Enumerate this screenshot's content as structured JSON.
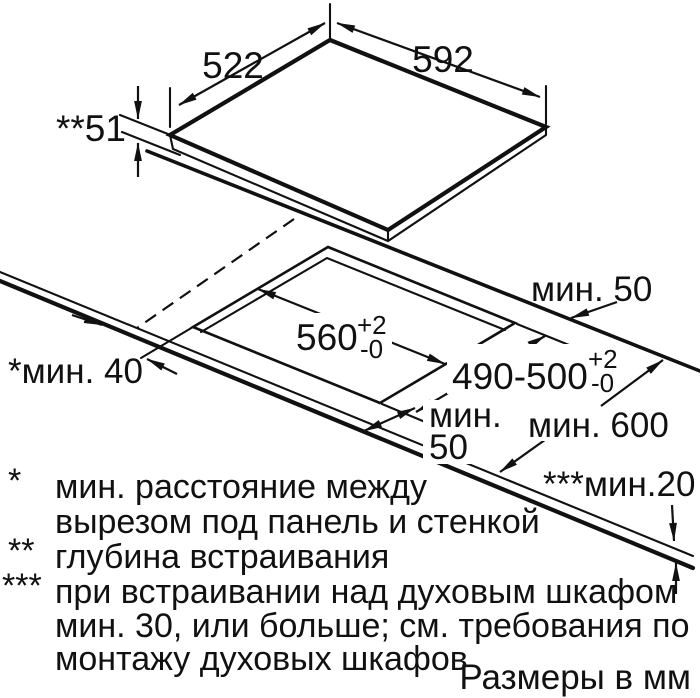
{
  "units_note": "Размеры в мм",
  "colors": {
    "ink": "#111111",
    "background": "#ffffff"
  },
  "dimensions": {
    "cooktop_depth": "522",
    "cooktop_width": "592",
    "build_in_depth": "**51",
    "cutout_width": "560",
    "tolerance_plus": "+2",
    "tolerance_minus": "-0",
    "cutout_depth": "490-500",
    "min_back_clearance": "мин. 50",
    "min_side_clearance": "*мин. 40",
    "min_front_clearance_word": "мин.",
    "min_front_clearance_value": "50",
    "min_worktop_depth": "мин. 600",
    "min_bottom_gap": "***мин.20"
  },
  "footnotes": {
    "star1_marker": "*",
    "star1_line1": "мин. расстояние между",
    "star1_line2": "вырезом под панель и стенкой",
    "star2_marker": "**",
    "star2_line1": "глубина встраивания",
    "star3_marker": "***",
    "star3_line1": "при встраивании над духовым шкафом",
    "star3_line2": "мин. 30, или больше; см. требования по",
    "star3_line3": "монтажу духовых шкафов"
  }
}
